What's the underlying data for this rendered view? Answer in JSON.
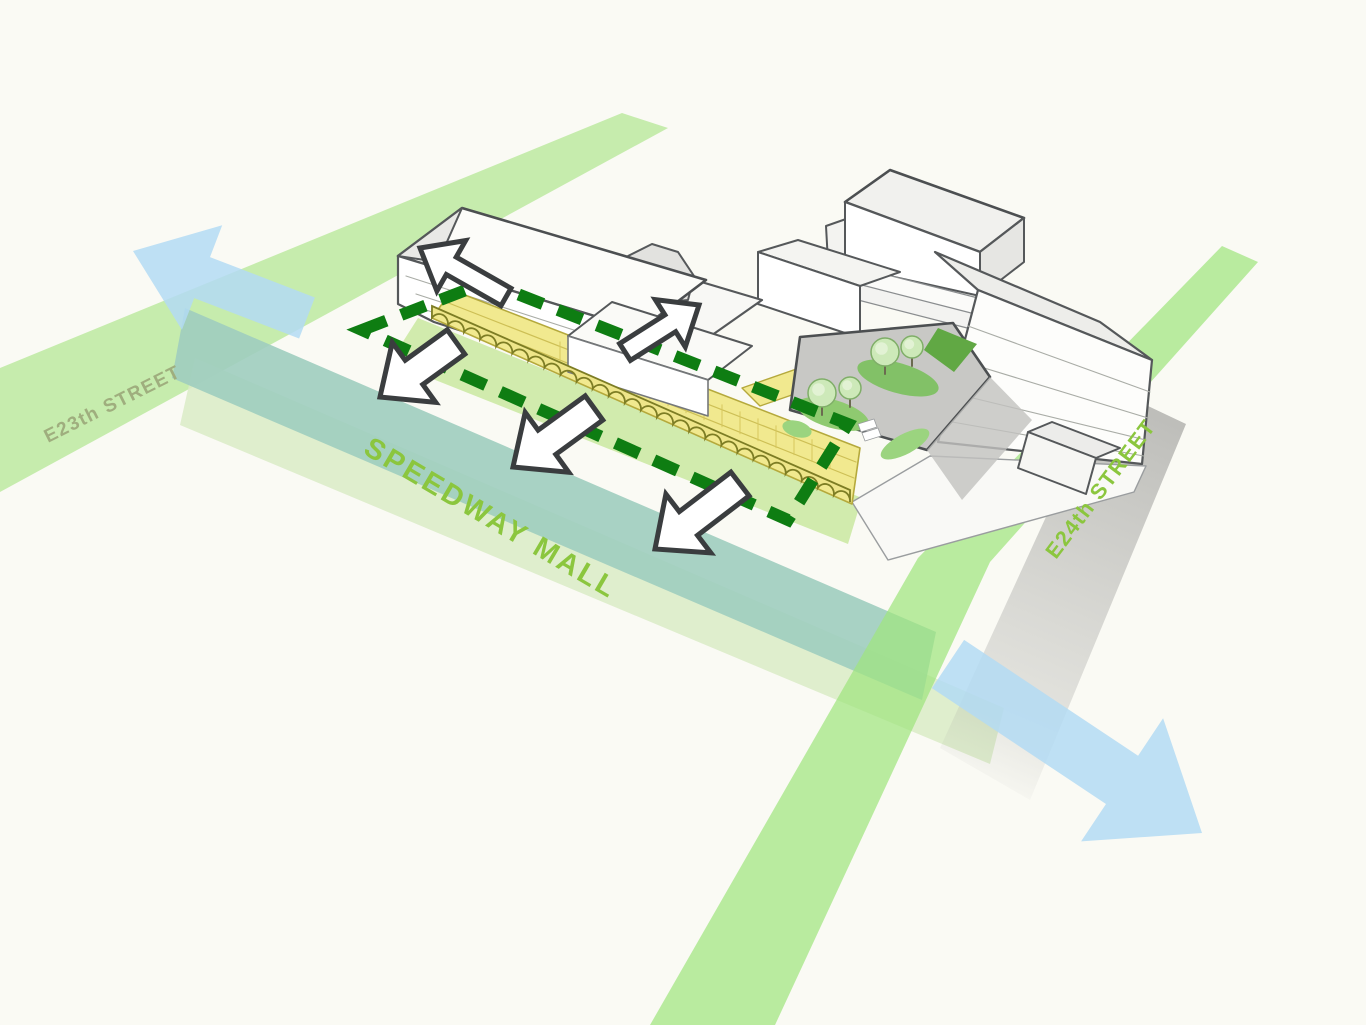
{
  "labels": {
    "street_top_left": "E23th STREET",
    "street_right": "E24th STREET",
    "mall": "SPEEDWAY MALL"
  },
  "colors": {
    "background": "#fafaf4",
    "e23_band_green": "#b9e89b",
    "e24_band_green": "#9fe57e",
    "mall_teal": "#9fcdbf",
    "mall_sage": "#d9ebc6",
    "mall_verge": "#cfeaa9",
    "shadow_grey": "#9a9a98",
    "dashed_outline_green": "#0e7d12",
    "walkway_yellow": "#f1e98f",
    "walkway_edge": "#b5a93c",
    "arcade_yellow": "#eee589",
    "arcade_edge": "#7d7d24",
    "arrow_blue": "#b3daf3",
    "arrow_white": "#ffffff",
    "arrow_outline": "#3a3d3f",
    "label_green": "#8bc63e",
    "label_olive": "#9fae7e",
    "building_line": "#55585a",
    "building_white": "#ffffff",
    "roof_grey": "#ededea",
    "courtyard_grey": "#c8c8c5",
    "tree_green": "#cde9b9",
    "tree_edge": "#7fae68",
    "patch_green": "#82c167"
  },
  "icons": {
    "blue_arrows": [
      "blue-arrow-up-left",
      "blue-arrow-down-right"
    ],
    "white_arrows": [
      "white-arrow-up-left",
      "white-arrow-down-left-1",
      "white-arrow-up-right",
      "white-arrow-down-left-2",
      "white-arrow-down-left-3"
    ],
    "route": "dashed-arcade-route-outline"
  }
}
